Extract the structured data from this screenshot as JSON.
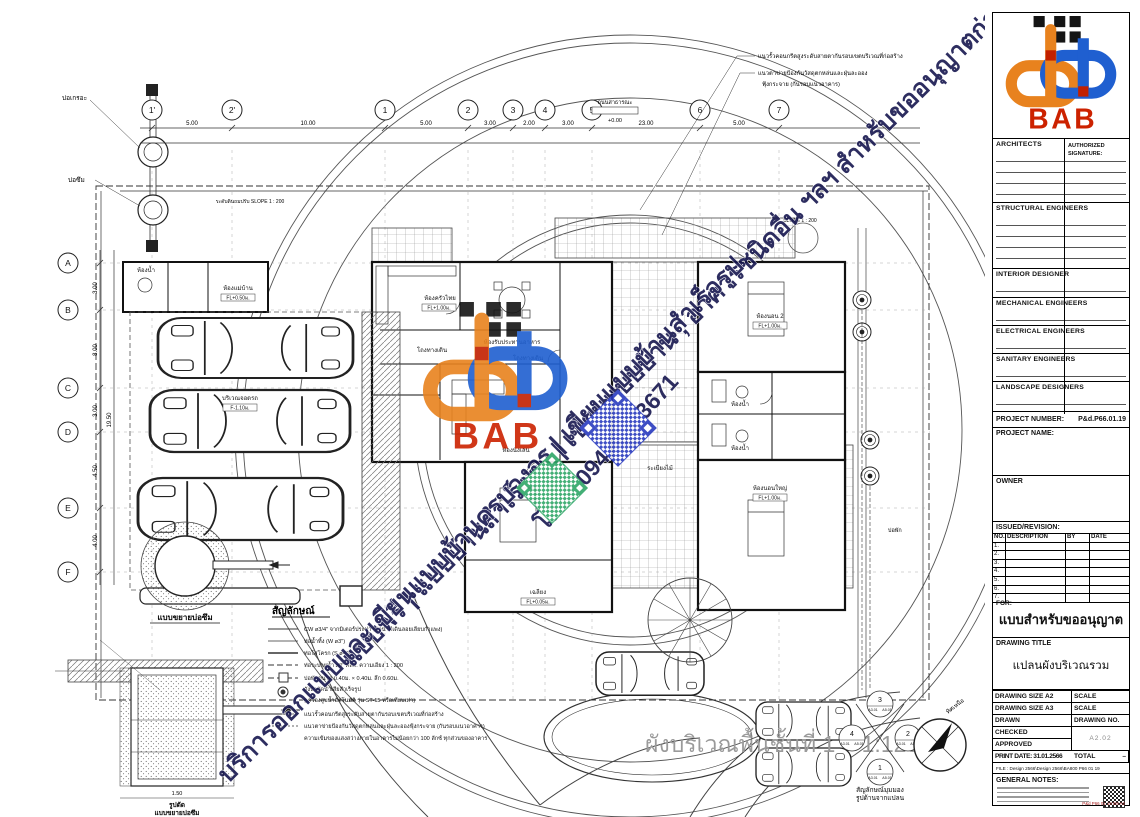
{
  "logo": {
    "text": "BAB"
  },
  "titleblock": {
    "sections": [
      "ARCHITECTS",
      "STRUCTURAL ENGINEERS",
      "INTERIOR  DESIGNER",
      "MECHANICAL ENGINEERS",
      "ELECTRICAL ENGINEERS",
      "SANITARY ENGINEERS",
      "LANDSCAPE DESIGNERS"
    ],
    "authorized_1": "AUTHORIZED",
    "authorized_2": "SIGNATURE:",
    "project_number_label": "PROJECT NUMBER:",
    "project_number": "P&d.P66.01.19",
    "project_name_label": "PROJECT NAME:",
    "owner_label": "OWNER",
    "revision": {
      "title": "ISSUED/REVISION:",
      "cols": [
        "NO.",
        "DESCRIPTION",
        "BY",
        "DATE"
      ],
      "rows": [
        "1.",
        "2.",
        "3.",
        "4.",
        "5.",
        "6.",
        "7."
      ]
    },
    "for_label": "FOR:",
    "for_value": "แบบสำหรับขออนุญาต",
    "drawing_title_label": "DRAWING TITLE",
    "drawing_title": "แปลนผังบริเวณรวม",
    "info": {
      "size_a2": "DRAWING SIZE A2",
      "size_a3": "DRAWING SIZE A3",
      "scale": "SCALE",
      "drawn": "DRAWN",
      "drawing_no": "DRAWING NO.",
      "checked": "CHECKED",
      "approved": "APPROVED",
      "sheet_no": "A2.02",
      "print_date": "PRINT DATE: 31.01.2566",
      "total": "TOTAL",
      "total_value": "–"
    },
    "file_line": "FILE : Design 2566\\Design 2566\\BA800 P66 01 19",
    "general_notes_label": "GENERAL NOTES:",
    "footer_code": "P&d P66 01 19 D8 A2"
  },
  "watermark": {
    "line1": "แบบฟรี | แบบบ้านสำเร็จรูป | เขียนแบบบ้าน , อาคารชนิดอื่น ฯลฯ สำหรับขออนุญาตก่อสร้าง",
    "line2": "บริการออกแบบและเขียนแบบบ้านครบวงจร | เขียนแบบบ้านสำเร็จรูป",
    "phone": "โทร : 094 598 3671",
    "navy": "#17174f",
    "orange": "#E8821E",
    "blue": "#1F5FD0",
    "red": "#C42200"
  },
  "plan": {
    "grid_top": [
      "1'",
      "2'",
      "1",
      "2",
      "3",
      "4",
      "5",
      "6",
      "7"
    ],
    "grid_left": [
      "A",
      "B",
      "C",
      "D",
      "E",
      "F"
    ],
    "dims_top": [
      "5.00",
      "10.00",
      "5.00",
      "3.00",
      "2.00",
      "3.00",
      "23.00",
      "5.00"
    ],
    "dims_left": [
      "3.00",
      "8.00",
      "3.00",
      "4.50",
      "4.00"
    ],
    "dim_total_left": "19.50",
    "manhole_1": "บ่อเกรอะ",
    "manhole_2": "บ่อซึม",
    "road_label": "ถนนสาธารณะ",
    "elev_road": "+0.00",
    "slope_note": "ระดับดินถมปรับ SLOPE 1 : 200",
    "slope_note_2": "SLOPE 1 : 200",
    "rooms": [
      "ห้องแม่บ้าน",
      "ห้องน้ำ",
      "บริเวณจอดรถ",
      "ห้องครัวไทย",
      "ห้องรับประทานอาหาร",
      "โถงทางเดิน",
      "โถงทางเดิน",
      "ห้องนั่งเล่น",
      "ห้องนอน 2",
      "ห้องน้ำ",
      "ห้องน้ำ",
      "ห้องนอนใหญ่",
      "เฉลียง",
      "ระเบียงไม้",
      "บ่อพัก"
    ],
    "fl_tags": [
      "FL+1.00ม.",
      "FL+0.50ม.",
      "FL+0.05ม.",
      "+0.00",
      "F-1.10ม."
    ],
    "notes_top": [
      "แนวรั้วคอนกรีตสูงระดับสายตากันรอบเขตบริเวณที่ก่อสร้าง",
      "แนวตาข่ายป้องกันวัสดุตกหล่นและฝุ่นละออง",
      "ฟุ้งกระจาย (กันรอบแนวอาคาร)"
    ],
    "legend": {
      "title": "สัญลักษณ์",
      "items": [
        "CW ø3/4\" จากมิเตอร์ประปา (ท่อน้ำดีเดินลอยเลียบกำแพง)",
        "ท่อน้ำทิ้ง (W ø3\")",
        "ท่อโสโครก (S ø4\")",
        "ท่อระบายน้ำ ø8\" คสล. ความเอียง 1 : 200",
        "บ่อพักขนาด 0.40ม. × 0.40ม. ลึก 0.60ม.",
        "ถังบำบัดน้ำเสียสำเร็จรูป",
        "(เครื่องสูบน้ำอัตโนมัติ รุ่น ST-15 หรือเทียบเท่า)",
        "แนวรั้วคอนกรีตสูงระดับสายตากันรอบเขตบริเวณที่ก่อสร้าง",
        "แนวตาข่ายป้องกันวัสดุตกหล่นและฝุ่นละอองฟุ้งกระจาย (กันรอบแนวอาคาร)",
        "ความเข้มของแสงสว่างภายในอาคารไม่น้อยกว่า 100 ลักซ์ ทุกส่วนของอาคาร"
      ]
    },
    "details": {
      "pit_plan_caption": "แบบขยายบ่อซึม",
      "pit_section_caption_1": "รูปตัด",
      "pit_section_caption_2": "แบบขยายบ่อซึม",
      "pit_dim": "1.50"
    },
    "view_symbol": {
      "numbers": [
        "1",
        "2",
        "3",
        "4"
      ],
      "ref_a": "A3.01",
      "ref_b": "A5.01",
      "caption_1": "สัญลักษณ์มุมมอง",
      "caption_2": "รูปด้านจากแปลน"
    },
    "main_caption": "ผังบริเวณพื้นชั้นที่ 1",
    "main_scale": "1:125",
    "compass_north": "ทิศเหนือ"
  }
}
